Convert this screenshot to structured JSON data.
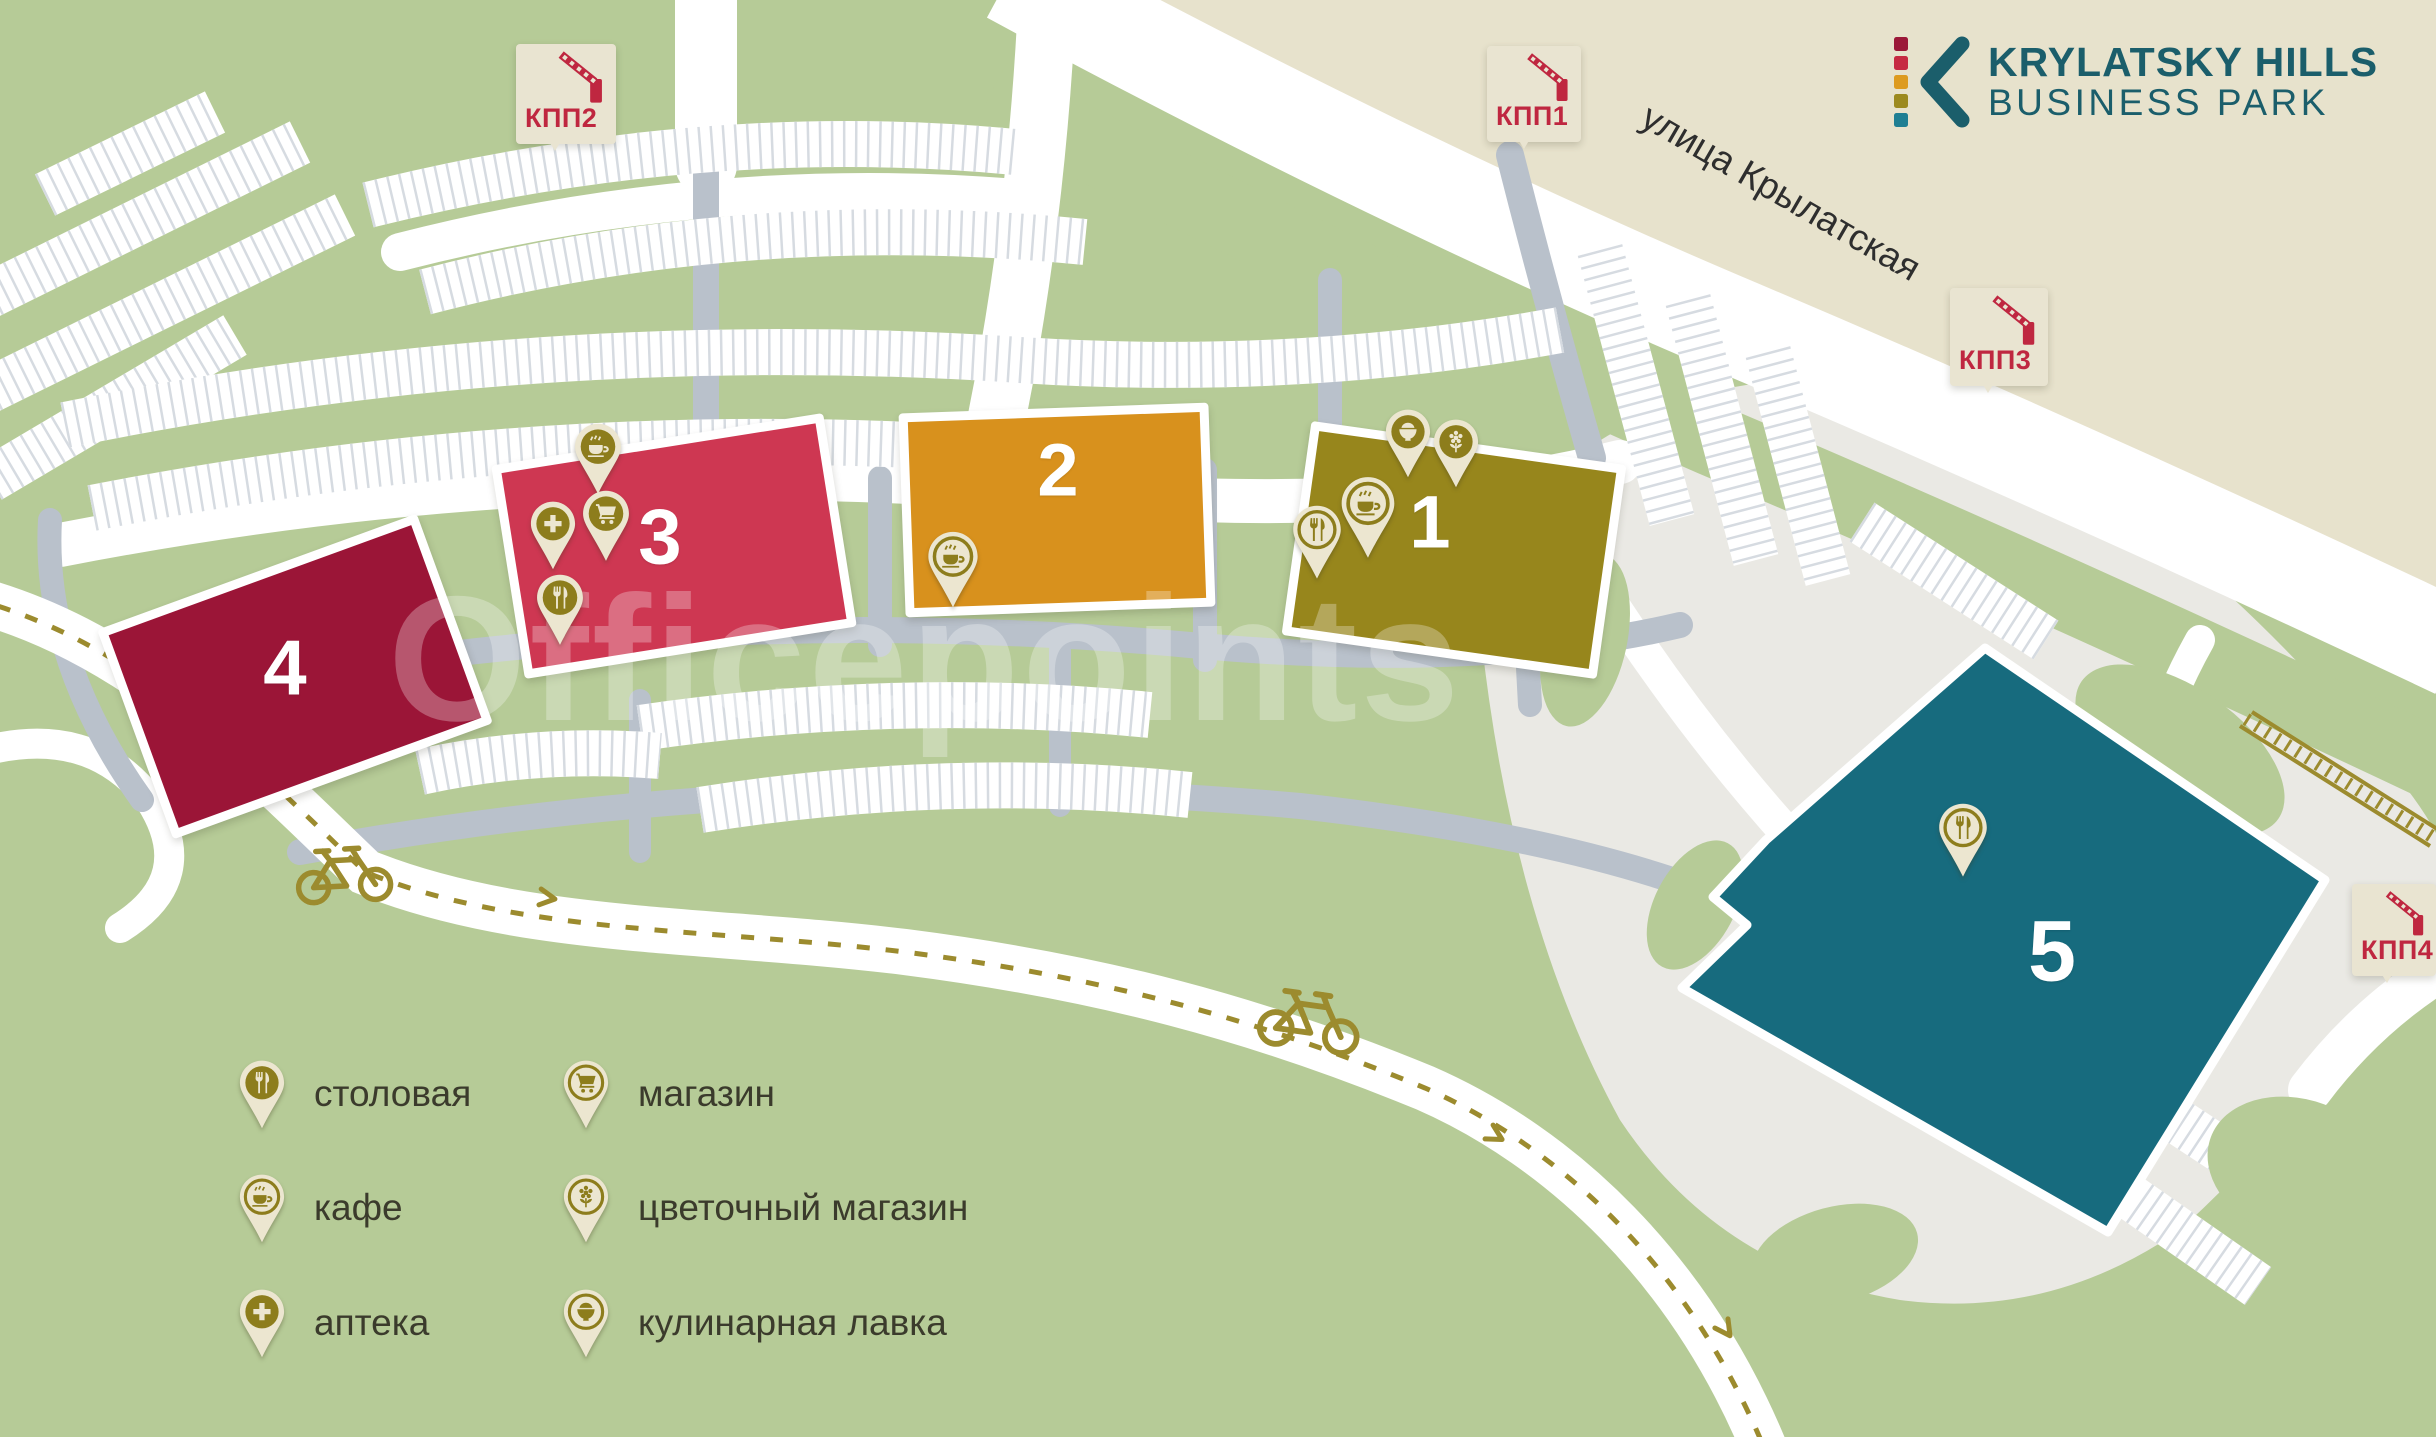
{
  "logo": {
    "title": "KRYLATSKY HILLS",
    "subtitle": "BUSINESS PARK",
    "square_colors": [
      "#9b1838",
      "#c62a42",
      "#dd9b20",
      "#9c8a1f",
      "#1f7f93"
    ]
  },
  "street": {
    "name": "улица Крылатская"
  },
  "watermark": "Officepoints",
  "checkpoints": [
    {
      "label": "КПП1"
    },
    {
      "label": "КПП2"
    },
    {
      "label": "КПП3"
    },
    {
      "label": "КПП4"
    }
  ],
  "buildings": [
    {
      "number": "1",
      "color": "#97861c"
    },
    {
      "number": "2",
      "color": "#d8911d"
    },
    {
      "number": "3",
      "color": "#ce3752"
    },
    {
      "number": "4",
      "color": "#9b1537"
    },
    {
      "number": "5",
      "color": "#176b7e"
    }
  ],
  "building_pins": {
    "b1": [
      "culinary",
      "flower",
      "cafe",
      "canteen"
    ],
    "b2": [
      "cafe"
    ],
    "b3": [
      "cafe",
      "shop",
      "pharmacy",
      "canteen"
    ],
    "b5": [
      "canteen"
    ]
  },
  "legend": [
    {
      "icon": "canteen",
      "label": "столовая"
    },
    {
      "icon": "shop",
      "label": "магазин"
    },
    {
      "icon": "cafe",
      "label": "кафе"
    },
    {
      "icon": "flower",
      "label": "цветочный магазин"
    },
    {
      "icon": "pharmacy",
      "label": "аптека"
    },
    {
      "icon": "culinary",
      "label": "кулинарная лавка"
    }
  ],
  "colors": {
    "background": "#b6cb97",
    "road_gray": "#b9c1cb",
    "parking_tick": "#d6dbe1",
    "beige": "#e7e2cc",
    "plaza": "#eae9e4",
    "pin_olive": "#8d7d1c",
    "pin_cream": "#ece6d0",
    "kpp_red": "#bf2740",
    "path_dash": "#9c8b2e"
  }
}
